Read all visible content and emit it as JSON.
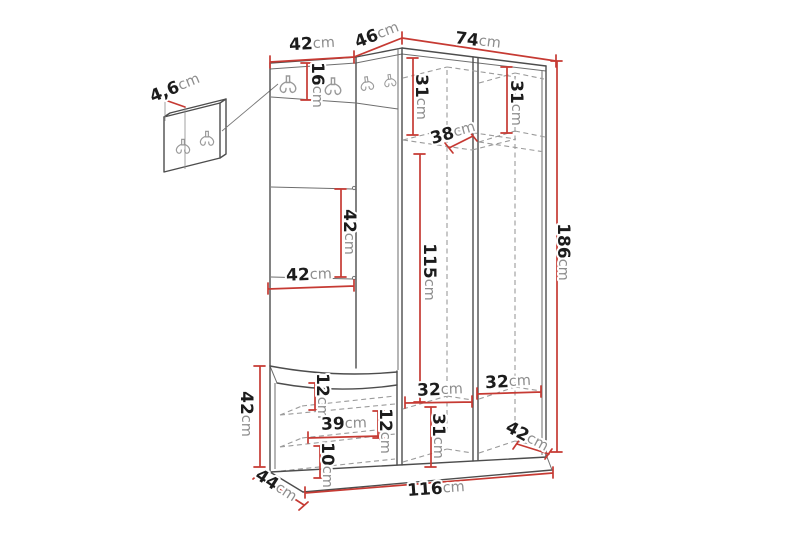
{
  "diagram": {
    "type": "furniture-dimension-drawing",
    "subject": "corner hallway unit with coat hooks, open wardrobe and bench, plus separate wall hook panel",
    "background_color": "#ffffff",
    "colors": {
      "dimension_lines": "#c63a33",
      "structure_lines": "#4d4d4d",
      "hidden_dashed_lines": "#9b9b9b",
      "label_number": "#1c1c1c",
      "label_unit": "#8d8d8d"
    },
    "dimensions": {
      "panel_thickness": {
        "value": "4,6",
        "unit": "cm"
      },
      "left_section_width": {
        "value": "42",
        "unit": "cm"
      },
      "corner_width": {
        "value": "46",
        "unit": "cm"
      },
      "right_section_width": {
        "value": "74",
        "unit": "cm"
      },
      "hook_rail_height": {
        "value": "16",
        "unit": "cm"
      },
      "bay1_top_height": {
        "value": "31",
        "unit": "cm"
      },
      "bay2_top_height": {
        "value": "31",
        "unit": "cm"
      },
      "shelf_depth": {
        "value": "38",
        "unit": "cm"
      },
      "panel_seam_spacing": {
        "value": "42",
        "unit": "cm"
      },
      "panel_width": {
        "value": "42",
        "unit": "cm"
      },
      "hanging_height": {
        "value": "115",
        "unit": "cm"
      },
      "total_height": {
        "value": "186",
        "unit": "cm"
      },
      "bench_height": {
        "value": "42",
        "unit": "cm"
      },
      "bench_top_gap": {
        "value": "12",
        "unit": "cm"
      },
      "bench_shelf_width": {
        "value": "39",
        "unit": "cm"
      },
      "bench_shelf_gap": {
        "value": "12",
        "unit": "cm"
      },
      "bench_bottom_gap": {
        "value": "10",
        "unit": "cm"
      },
      "bench_depth": {
        "value": "44",
        "unit": "cm"
      },
      "bay1_shelf_width": {
        "value": "32",
        "unit": "cm"
      },
      "bay2_shelf_width": {
        "value": "32",
        "unit": "cm"
      },
      "bay1_lower_height": {
        "value": "31",
        "unit": "cm"
      },
      "wardrobe_depth": {
        "value": "42",
        "unit": "cm"
      },
      "total_width": {
        "value": "116",
        "unit": "cm"
      }
    }
  }
}
